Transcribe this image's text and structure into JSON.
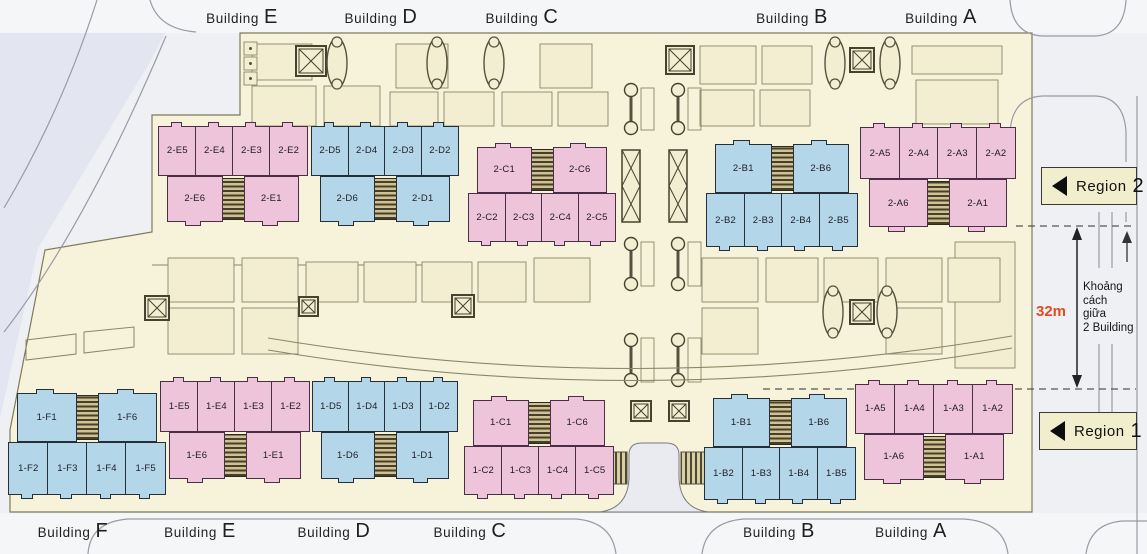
{
  "colors": {
    "pink": "#edc4da",
    "blue": "#b3d7e8",
    "site": "#f7f3da",
    "road": "#eef0f4",
    "accent_red": "#e24a20",
    "outline_pink": "#4a2e47",
    "outline_blue": "#262e3a"
  },
  "top_labels": [
    {
      "text": "Building E",
      "x": 242
    },
    {
      "text": "Building D",
      "x": 381
    },
    {
      "text": "Building C",
      "x": 522
    },
    {
      "text": "Building B",
      "x": 792
    },
    {
      "text": "Building A",
      "x": 941
    }
  ],
  "bottom_labels": [
    {
      "text": "Building F",
      "x": 73
    },
    {
      "text": "Building E",
      "x": 200
    },
    {
      "text": "Building D",
      "x": 334
    },
    {
      "text": "Building C",
      "x": 470
    },
    {
      "text": "Building B",
      "x": 779
    },
    {
      "text": "Building A",
      "x": 911
    }
  ],
  "regions": [
    {
      "label": "Region 2",
      "x": 1041,
      "y": 167,
      "w": 96,
      "h": 38
    },
    {
      "label": "Region 1",
      "x": 1039,
      "y": 412,
      "w": 98,
      "h": 38
    }
  ],
  "measurement": {
    "distance": "32m",
    "lines": [
      "Khoảng",
      "cách",
      "giữa",
      "2 Building"
    ]
  },
  "clusters": [
    {
      "id": "region2-building-e",
      "palette": "pink",
      "type": "4top",
      "x": 158,
      "y": 126,
      "w": 150,
      "h": 96,
      "outer": [
        "2-E5",
        "2-E4",
        "2-E3",
        "2-E2"
      ],
      "inner": [
        "2-E6",
        "2-E1"
      ]
    },
    {
      "id": "region2-building-d",
      "palette": "blue",
      "type": "4top",
      "x": 311,
      "y": 126,
      "w": 148,
      "h": 96,
      "outer": [
        "2-D5",
        "2-D4",
        "2-D3",
        "2-D2"
      ],
      "inner": [
        "2-D6",
        "2-D1"
      ]
    },
    {
      "id": "region2-building-c",
      "palette": "pink",
      "type": "2top",
      "x": 468,
      "y": 147,
      "w": 148,
      "h": 95,
      "outer": [
        "2-C2",
        "2-C3",
        "2-C4",
        "2-C5"
      ],
      "inner": [
        "2-C1",
        "2-C6"
      ]
    },
    {
      "id": "region2-building-b",
      "palette": "blue",
      "type": "2top",
      "x": 706,
      "y": 144,
      "w": 152,
      "h": 103,
      "outer": [
        "2-B2",
        "2-B3",
        "2-B4",
        "2-B5"
      ],
      "inner": [
        "2-B1",
        "2-B6"
      ]
    },
    {
      "id": "region2-building-a",
      "palette": "pink",
      "type": "4top",
      "x": 860,
      "y": 127,
      "w": 156,
      "h": 100,
      "outer": [
        "2-A5",
        "2-A4",
        "2-A3",
        "2-A2"
      ],
      "inner": [
        "2-A6",
        "2-A1"
      ]
    },
    {
      "id": "region1-building-f",
      "palette": "blue",
      "type": "2top",
      "x": 8,
      "y": 393,
      "w": 158,
      "h": 102,
      "outer": [
        "1-F2",
        "1-F3",
        "1-F4",
        "1-F5"
      ],
      "inner": [
        "1-F1",
        "1-F6"
      ]
    },
    {
      "id": "region1-building-e",
      "palette": "pink",
      "type": "4top",
      "x": 160,
      "y": 381,
      "w": 150,
      "h": 98,
      "outer": [
        "1-E5",
        "1-E4",
        "1-E3",
        "1-E2"
      ],
      "inner": [
        "1-E6",
        "1-E1"
      ]
    },
    {
      "id": "region1-building-d",
      "palette": "blue",
      "type": "4top",
      "x": 312,
      "y": 381,
      "w": 146,
      "h": 98,
      "outer": [
        "1-D5",
        "1-D4",
        "1-D3",
        "1-D2"
      ],
      "inner": [
        "1-D6",
        "1-D1"
      ]
    },
    {
      "id": "region1-building-c",
      "palette": "pink",
      "type": "2top",
      "x": 464,
      "y": 400,
      "w": 150,
      "h": 95,
      "outer": [
        "1-C2",
        "1-C3",
        "1-C4",
        "1-C5"
      ],
      "inner": [
        "1-C1",
        "1-C6"
      ]
    },
    {
      "id": "region1-building-b",
      "palette": "blue",
      "type": "2top",
      "x": 704,
      "y": 398,
      "w": 152,
      "h": 102,
      "outer": [
        "1-B2",
        "1-B3",
        "1-B4",
        "1-B5"
      ],
      "inner": [
        "1-B1",
        "1-B6"
      ]
    },
    {
      "id": "region1-building-a",
      "palette": "pink",
      "type": "4top",
      "x": 855,
      "y": 384,
      "w": 158,
      "h": 96,
      "outer": [
        "1-A5",
        "1-A4",
        "1-A3",
        "1-A2"
      ],
      "inner": [
        "1-A6",
        "1-A1"
      ]
    }
  ]
}
